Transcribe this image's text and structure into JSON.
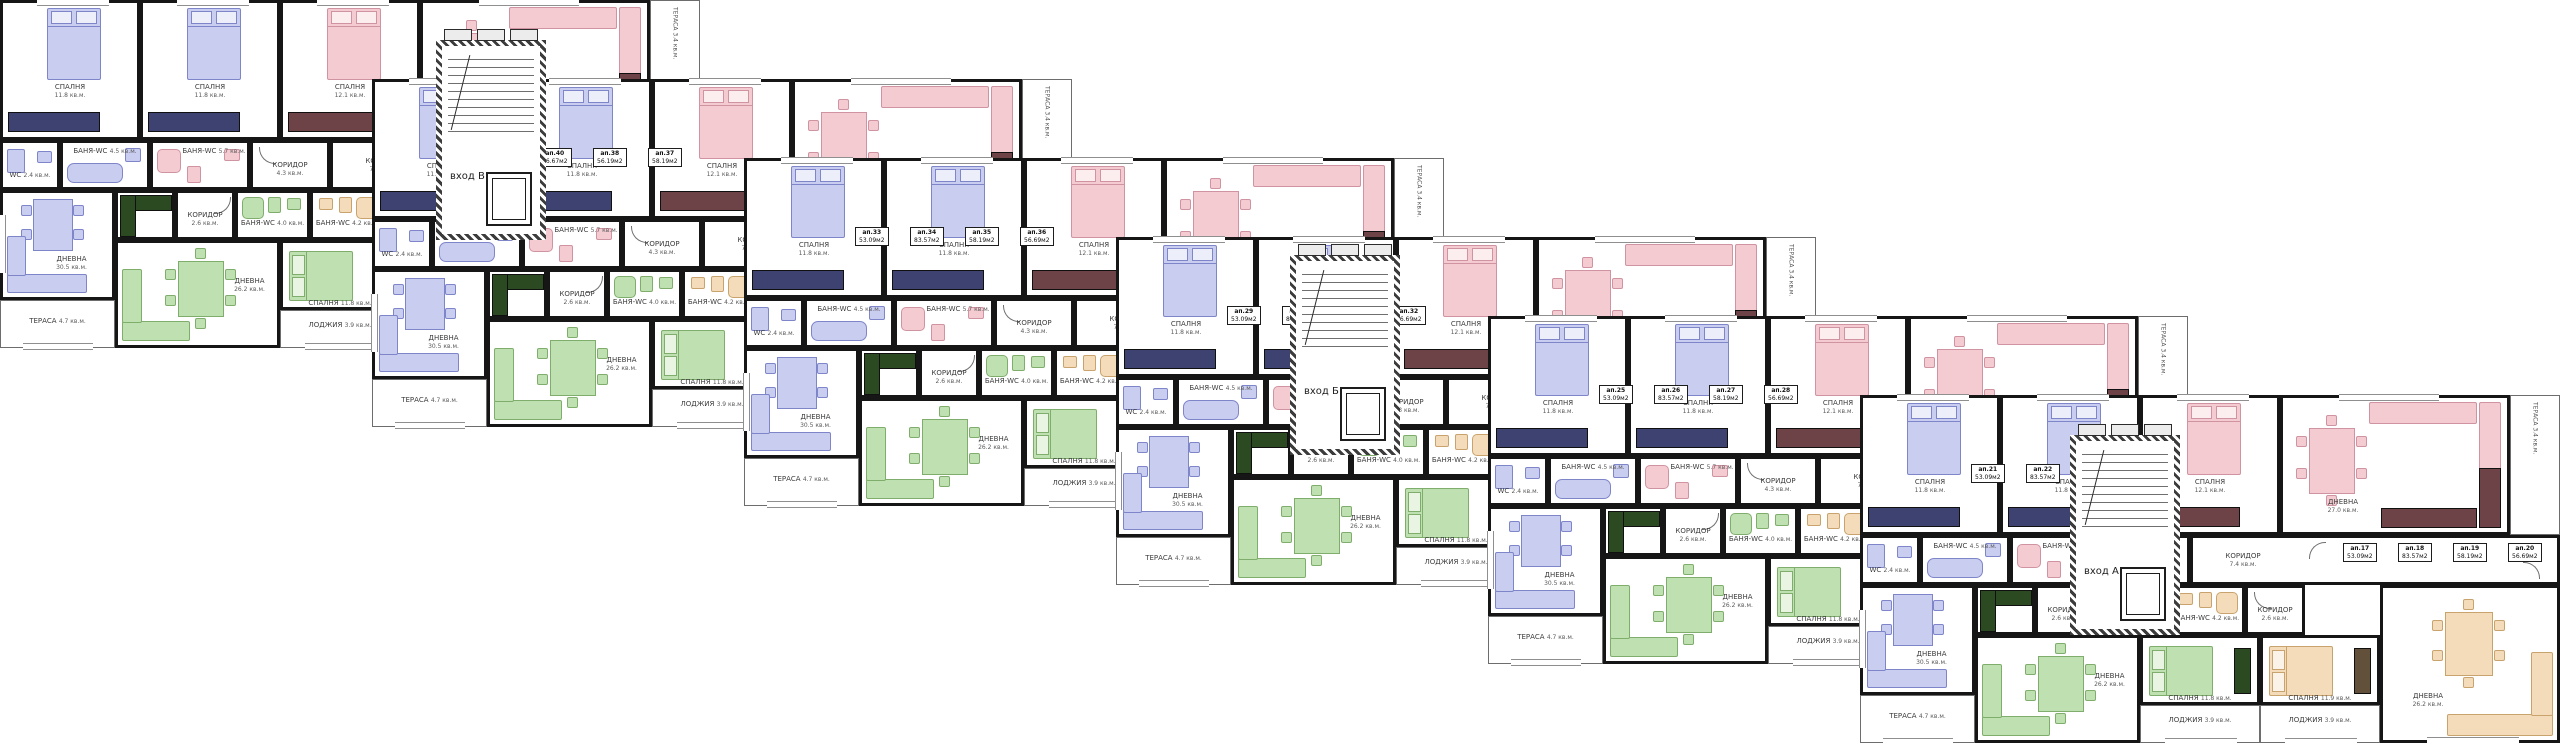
{
  "rooms": {
    "bedroom_a": {
      "label": "СПАЛНЯ",
      "area": "11.8 кв.м."
    },
    "bedroom_b": {
      "label": "СПАЛНЯ",
      "area": "11.8 кв.м."
    },
    "bedroom_c": {
      "label": "СПАЛНЯ",
      "area": "12.1 кв.м."
    },
    "living_top": {
      "label": "ДНЕВНА",
      "area": "27.0 кв.м."
    },
    "terrace_top": {
      "label": "ТЕРАСА",
      "area": "3.4 кв.м."
    },
    "wc": {
      "label": "WC",
      "area": "2.4 кв.м."
    },
    "bath_a": {
      "label": "БАНЯ-WC",
      "area": "4.5 кв.м."
    },
    "bath_b": {
      "label": "БАНЯ-WC",
      "area": "5.7 кв.м."
    },
    "corridor_a": {
      "label": "КОРИДОР",
      "area": "4.3 кв.м."
    },
    "corridor_main": {
      "label": "КОРИДОР",
      "area": "7.4 кв.м."
    },
    "living_left": {
      "label": "ДНЕВНА",
      "area": "30.5 кв.м."
    },
    "terrace_left": {
      "label": "ТЕРАСА",
      "area": "4.7 кв.м."
    },
    "corridor_b": {
      "label": "КОРИДОР",
      "area": "2.6 кв.м."
    },
    "bath_c": {
      "label": "БАНЯ-WC",
      "area": "4.0 кв.м."
    },
    "bath_d": {
      "label": "БАНЯ-WC",
      "area": "4.2 кв.м."
    },
    "corridor_c": {
      "label": "КОРИДОР",
      "area": "2.6 кв.м."
    },
    "living_b1": {
      "label": "ДНЕВНА",
      "area": "26.2 кв.м."
    },
    "bedroom_d": {
      "label": "СПАЛНЯ",
      "area": "11.8 кв.м."
    },
    "bedroom_e": {
      "label": "СПАЛНЯ",
      "area": "11.9 кв.м."
    },
    "living_b2": {
      "label": "ДНЕВНА",
      "area": "26.2 кв.м."
    },
    "loggia_a": {
      "label": "ЛОДЖИЯ",
      "area": "3.9 кв.м."
    },
    "loggia_b": {
      "label": "ЛОДЖИЯ",
      "area": "3.9 кв.м."
    }
  },
  "entrances": [
    {
      "label": "вход В"
    },
    {
      "label": "вход Б"
    },
    {
      "label": "вход А"
    }
  ],
  "modules": [
    {
      "stamps": [
        {
          "num": "ап.39",
          "area": "85.37м2"
        },
        {
          "num": "ап.40",
          "area": "56.67м2"
        },
        {
          "num": "ап.38",
          "area": "56.19м2"
        },
        {
          "num": "ап.37",
          "area": "58.19м2"
        }
      ]
    },
    {
      "stamps": [
        {
          "num": "ап.33",
          "area": "53.09м2"
        },
        {
          "num": "ап.34",
          "area": "83.57м2"
        },
        {
          "num": "ап.35",
          "area": "58.19м2"
        },
        {
          "num": "ап.36",
          "area": "56.69м2"
        }
      ]
    },
    {
      "stamps": [
        {
          "num": "ап.29",
          "area": "53.09м2"
        },
        {
          "num": "ап.30",
          "area": "83.57м2"
        },
        {
          "num": "ап.31",
          "area": "58.19м2"
        },
        {
          "num": "ап.32",
          "area": "56.69м2"
        }
      ]
    },
    {
      "stamps": [
        {
          "num": "ап.25",
          "area": "53.09м2"
        },
        {
          "num": "ап.26",
          "area": "83.57м2"
        },
        {
          "num": "ап.27",
          "area": "58.19м2"
        },
        {
          "num": "ап.28",
          "area": "56.69м2"
        }
      ]
    },
    {
      "stamps": [
        {
          "num": "ап.21",
          "area": "53.09м2"
        },
        {
          "num": "ап.22",
          "area": "83.57м2"
        },
        {
          "num": "ап.23",
          "area": "58.19м2"
        },
        {
          "num": "ап.24",
          "area": "56.69м2"
        }
      ]
    },
    {
      "stamps": [
        {
          "num": "ап.17",
          "area": "53.09м2"
        },
        {
          "num": "ап.18",
          "area": "83.57м2"
        },
        {
          "num": "ап.19",
          "area": "58.19м2"
        },
        {
          "num": "ап.20",
          "area": "56.69м2"
        }
      ]
    }
  ],
  "palette": {
    "wall": "#161616",
    "furniture_blue": "#c9cdf0",
    "furniture_pink": "#f5cbd2",
    "furniture_green": "#bfe0b0",
    "furniture_tan": "#f4dcba",
    "kitchen_dark_green": "#2c4a22",
    "kitchen_dark_maroon": "#6e4347",
    "wardrobe_navy": "#3d4270"
  }
}
